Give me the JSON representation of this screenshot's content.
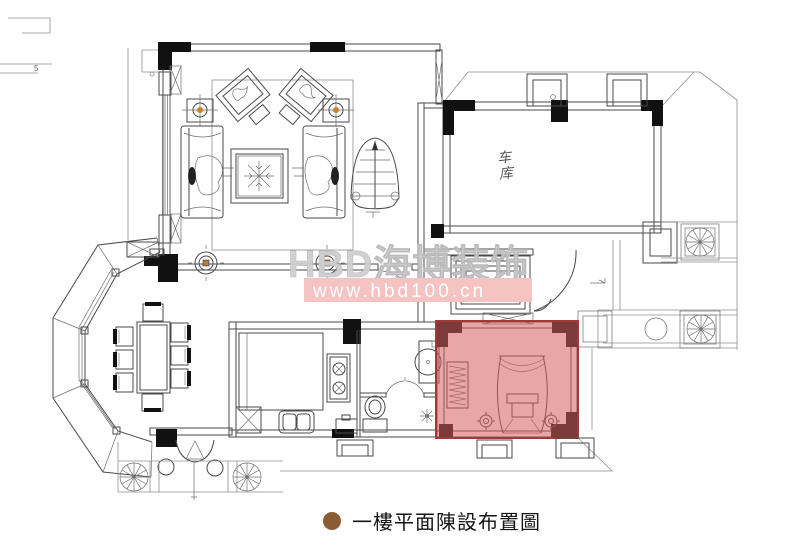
{
  "watermark": {
    "brand_text": "HBD海博装饰",
    "url_text": "www.hbd100.cn",
    "brand_color": "#cfcfcf",
    "band_color": "#f5c3c2",
    "url_color": "#ffffff"
  },
  "caption": {
    "text": "一樓平面陳設布置圖",
    "bullet_color": "#8a5c33"
  },
  "labels": {
    "garage": "车库",
    "exterior_note": "5"
  },
  "highlight": {
    "room": "highlighted-bedroom",
    "fill": "#d65c5c",
    "fill_opacity": 0.55,
    "border": "#9e3a3a"
  },
  "palette": {
    "background": "#ffffff",
    "wall_fill": "#111111",
    "line": "#4a4a4a",
    "light_line": "#909090",
    "lamp_accent": "#c8832a"
  },
  "symbols": [
    "tree-icon",
    "column-icon",
    "spiral-staircase-icon",
    "sofa",
    "armchair",
    "coffee-table-rug",
    "floor-lamp-icon",
    "dining-table",
    "dining-chair",
    "canopy-bed",
    "clothes-rack",
    "toilet",
    "sink",
    "shower-icon",
    "stove-burners",
    "loveseat",
    "entry-door-arc",
    "threshold-cross"
  ]
}
